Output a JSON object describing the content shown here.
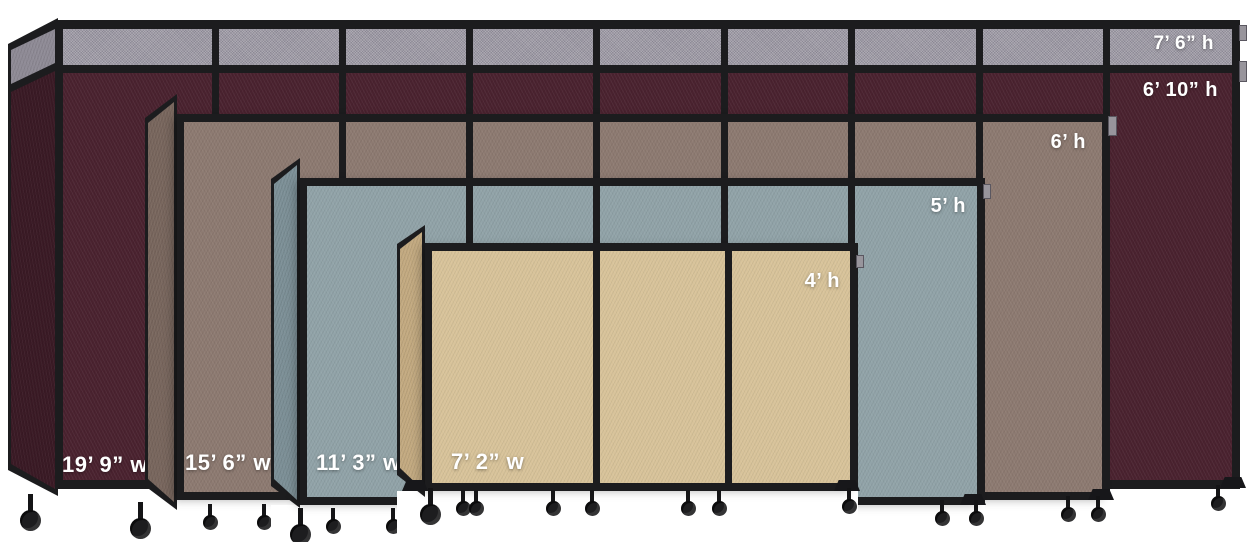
{
  "background_color": "#ffffff",
  "frame_color": "#1c1c1e",
  "partitions": [
    {
      "name": "cranberry",
      "fabric_color": "#4a222f",
      "end_panel_color": "#3a1a25",
      "topper_color": "#9e9aa4",
      "height_label_primary": "7’ 6” h",
      "height_label_secondary": "6’ 10” h",
      "width_label": "19’ 9” w"
    },
    {
      "name": "mocha",
      "fabric_color": "#8d7a71",
      "end_panel_color": "#79675e",
      "height_label": "6’ h",
      "width_label": "15’ 6” w"
    },
    {
      "name": "ocean",
      "fabric_color": "#91a3a8",
      "end_panel_color": "#7d9097",
      "height_label": "5’ h",
      "width_label": "11’ 3” w"
    },
    {
      "name": "sand",
      "fabric_color": "#d8c39a",
      "end_panel_color": "#c3aa81",
      "height_label": "4’ h",
      "width_label": "7’ 2” w"
    }
  ]
}
